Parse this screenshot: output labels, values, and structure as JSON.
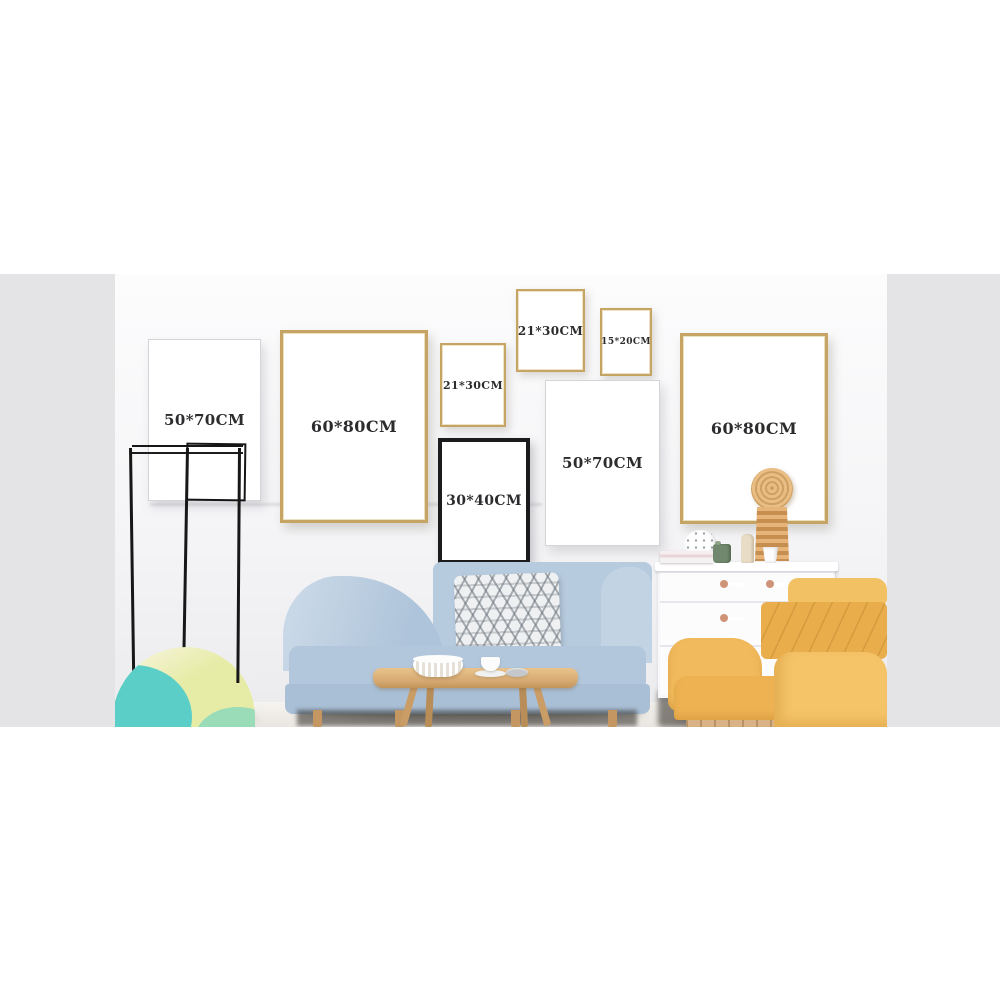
{
  "photo": {
    "alt": "Living room photograph used as a picture-frame size chart",
    "frames": [
      {
        "label": "50*70CM",
        "finish": "white"
      },
      {
        "label": "60*80CM",
        "finish": "gold"
      },
      {
        "label": "21*30CM",
        "finish": "gold"
      },
      {
        "label": "30*40CM",
        "finish": "black"
      },
      {
        "label": "21*30CM",
        "finish": "gold"
      },
      {
        "label": "15*20CM",
        "finish": "gold"
      },
      {
        "label": "50*70CM",
        "finish": "white"
      },
      {
        "label": "60*80CM",
        "finish": "gold"
      }
    ]
  },
  "colors": {
    "gold_frame": "#c5a464",
    "black_frame": "#1b1b1d",
    "white_frame": "#d4d4d8",
    "frame_text": "#2c2c2e",
    "side_band": "#e4e4e7",
    "sofa_blue": "#b7cbdf",
    "chair_yellow": "#efb758",
    "wood": "#c39662",
    "teal": "#5bcfc7",
    "pouf_green": "#e6eca6",
    "knob_pink": "#cf9478",
    "pot_green": "#72886e"
  }
}
